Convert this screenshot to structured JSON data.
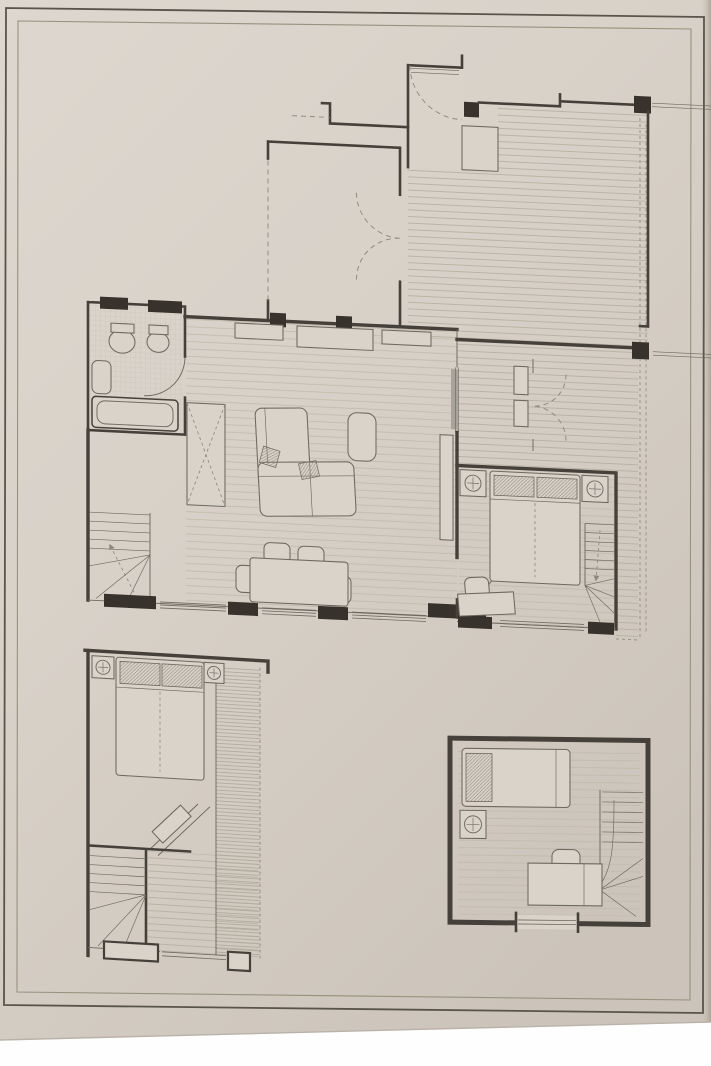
{
  "photo": {
    "description": "photograph of a hand-drafted architectural floor plan sheet",
    "bottom_margin": "white photo background strip"
  },
  "colors": {
    "white": "#fefefe",
    "paper": "#d8d1c8",
    "paper2": "#d9d3ca",
    "paperLight": "#ddd7cf",
    "paperDark": "#ccc4ba",
    "paperEdge": "#a79e92",
    "borderOuter": "#59544b",
    "borderInner": "#97917f",
    "wall": "#45413a",
    "wallDark": "#37332c",
    "line": "#6e6960",
    "dashed": "#8f897d",
    "hatchDeck": "#b4ae9f",
    "hatchFloor": "#bfb9ab",
    "hatchDense": "#a8a294",
    "tile": "#c6c0b2",
    "pillow": "#857f72",
    "panel": "#a8a49c"
  },
  "sheet": {
    "border": "double rectangular frame",
    "orientation": "slightly skewed by camera angle"
  },
  "plan": {
    "main_floor": {
      "rooms": [
        {
          "name": "entry-vestibule",
          "features": [
            "entry-door-swing",
            "threshold",
            "closet",
            "column"
          ]
        },
        {
          "name": "upper-room",
          "features": [
            "double-door-swing",
            "dashed-roof-line"
          ]
        },
        {
          "name": "terrace-deck",
          "features": [
            "deck-board-hatch",
            "railing",
            "columns",
            "dashed-edge",
            "terrace-double-door"
          ]
        },
        {
          "name": "bathroom",
          "fixtures": [
            "toilet",
            "bidet",
            "washbasin",
            "bathtub"
          ],
          "floor": "tile-grid"
        },
        {
          "name": "living-dining-room",
          "furniture": [
            "wall-cabinets",
            "corner-sofa",
            "cushions",
            "coffee-table",
            "dining-table",
            "dining-chairs",
            "tv-sideboard",
            "x-wardrobe"
          ],
          "floor": "plank-hatch"
        },
        {
          "name": "bedroom-1",
          "furniture": [
            "double-bed",
            "pillows",
            "nightstands",
            "table-lamps",
            "desk",
            "chair"
          ],
          "features": [
            "stair-run",
            "window"
          ]
        }
      ],
      "circulation": [
        "west-winder-stair",
        "down-arrow"
      ],
      "structure": [
        "south-window-piers"
      ]
    },
    "lower_left_unit": {
      "rooms": [
        {
          "name": "bedroom-2",
          "furniture": [
            "double-bed",
            "pillows",
            "nightstands",
            "table-lamps",
            "corner-desk"
          ],
          "features": [
            "dense-hatch-strip",
            "winder-stair",
            "window-piers"
          ]
        }
      ]
    },
    "lower_right_unit": {
      "rooms": [
        {
          "name": "bedroom-3",
          "furniture": [
            "single-bed",
            "pillow",
            "nightstand",
            "table-lamp",
            "desk",
            "chair"
          ],
          "features": [
            "stair-run-with-winders",
            "window-bay"
          ],
          "floor": "plank-hatch"
        }
      ]
    }
  }
}
